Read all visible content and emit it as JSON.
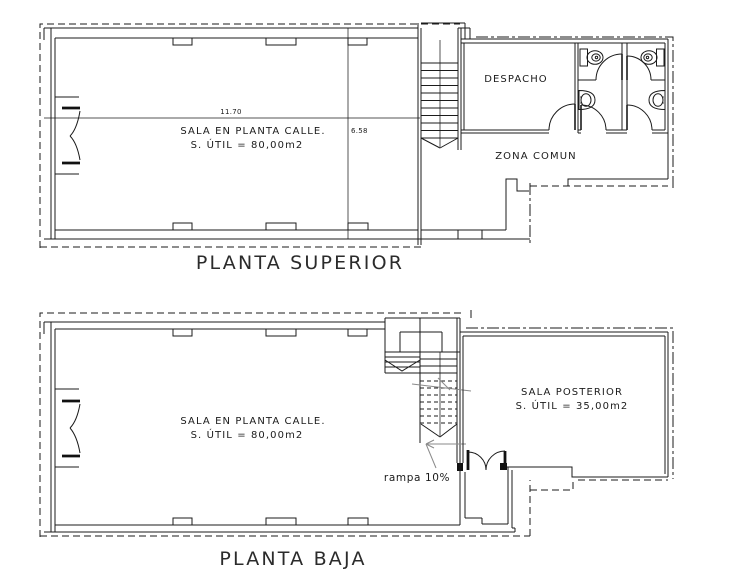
{
  "drawing": {
    "colors": {
      "line": "#1b1b1b",
      "muted_line": "#8a8a8a",
      "background": "#ffffff"
    },
    "planta_superior": {
      "title": "PLANTA SUPERIOR",
      "sala_calle": {
        "name": "SALA EN PLANTA CALLE.",
        "area": "S. ÚTIL = 80,00m2"
      },
      "despacho_label": "DESPACHO",
      "zona_comun_label": "ZONA COMUN",
      "dim_width": "11.70",
      "dim_height": "6.58"
    },
    "planta_baja": {
      "title": "PLANTA BAJA",
      "sala_calle": {
        "name": "SALA EN PLANTA CALLE.",
        "area": "S. ÚTIL = 80,00m2"
      },
      "sala_posterior": {
        "name": "SALA POSTERIOR",
        "area": "S. ÚTIL = 35,00m2"
      },
      "ramp_label": "rampa 10%"
    }
  }
}
